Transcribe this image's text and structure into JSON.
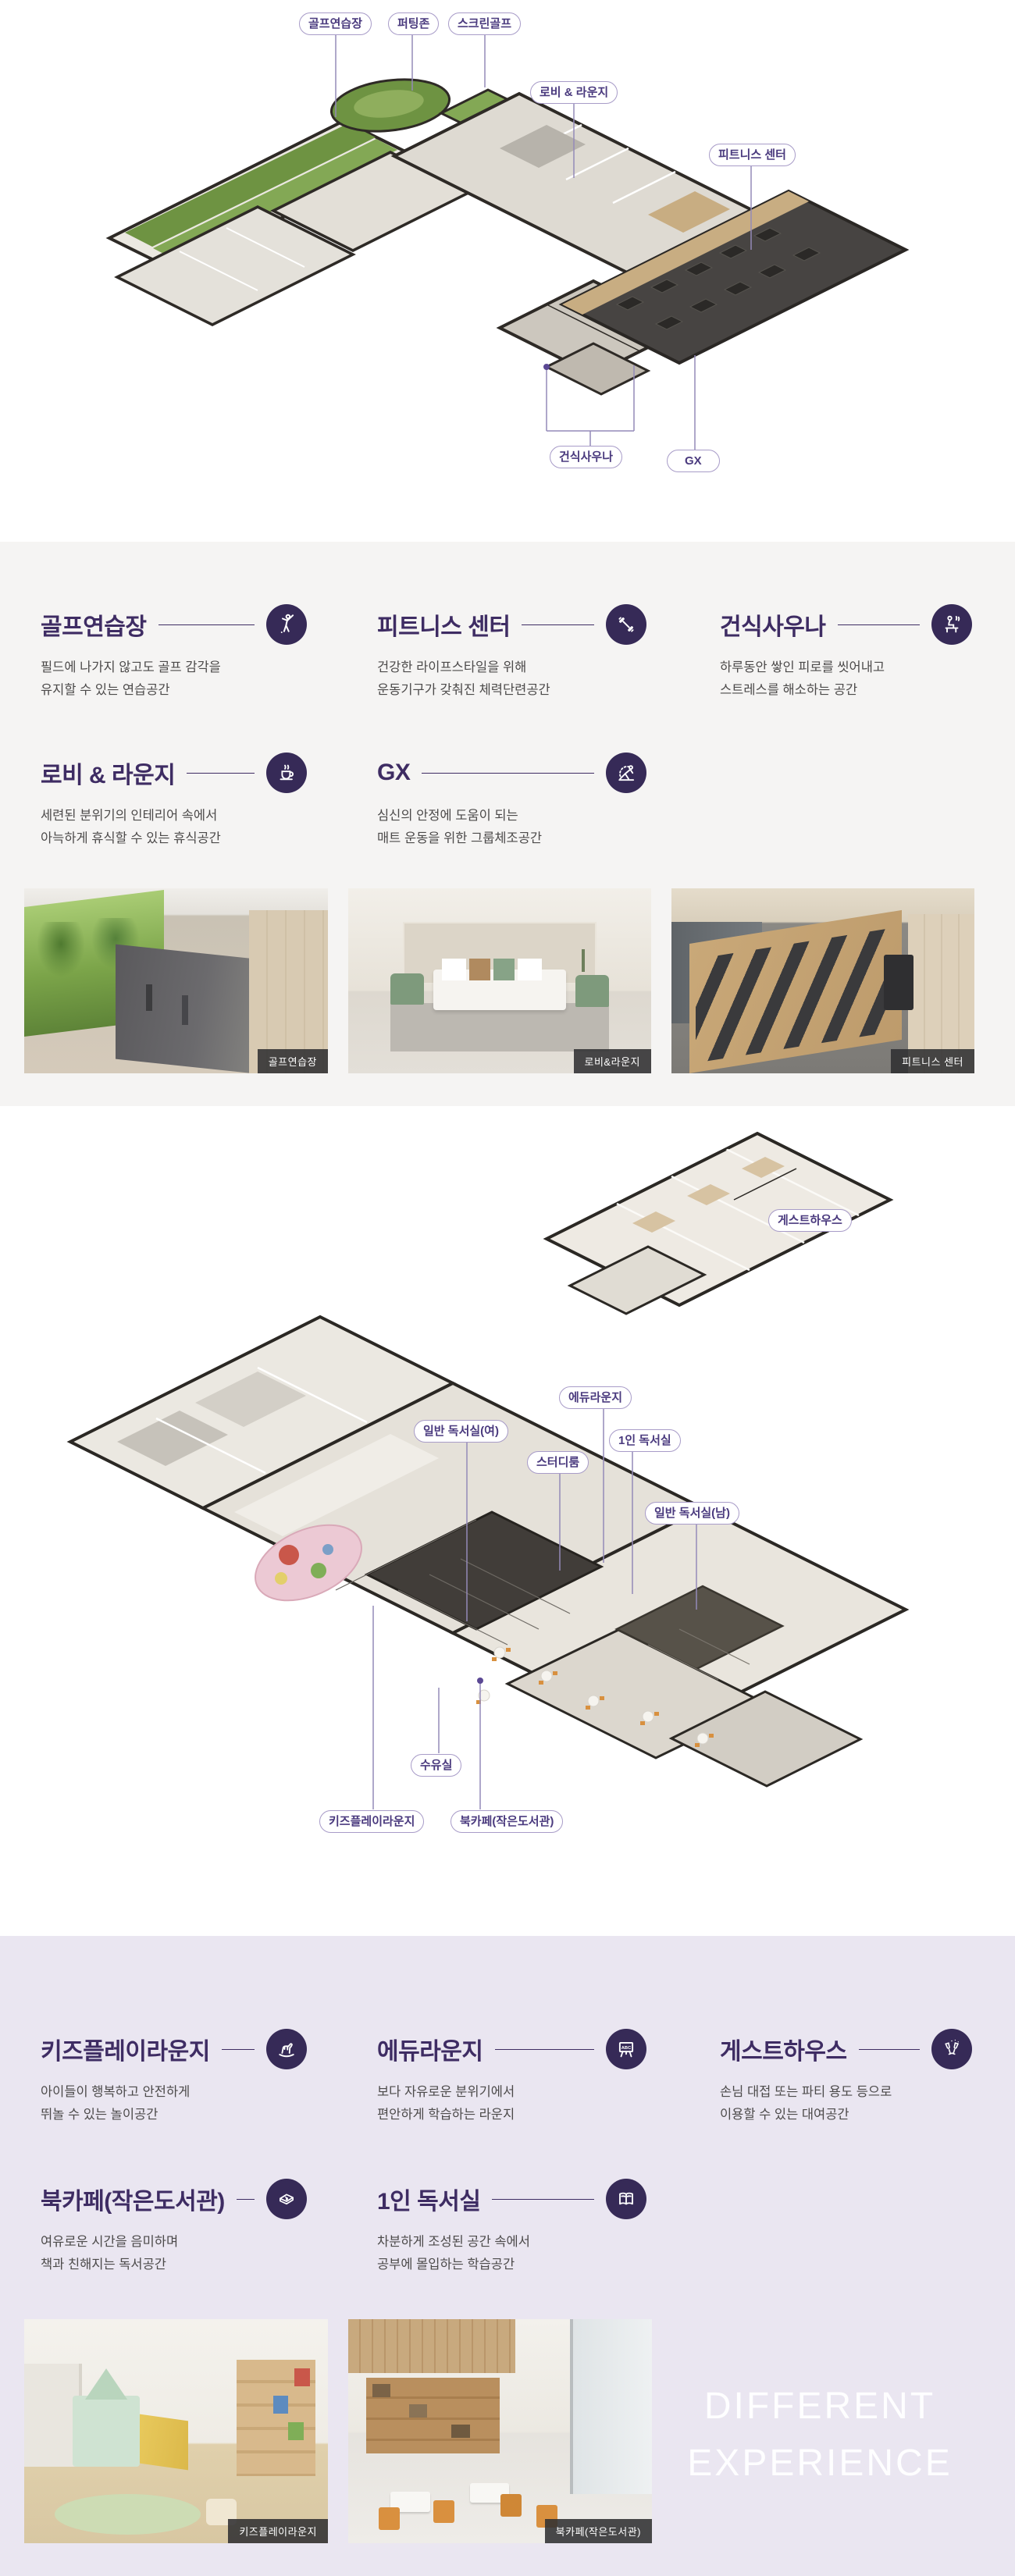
{
  "theme": {
    "accent": "#3e2c63",
    "icon_circle_bg": "#362a57",
    "label_border": "#a89cc8",
    "label_text": "#4a3a7e",
    "section1_bg": "#f5f4f3",
    "section2_bg": "#eae6f1",
    "caption_bg": "#303032",
    "connector_line": "#948ab8"
  },
  "plan1": {
    "labels": [
      {
        "text": "골프연습장"
      },
      {
        "text": "퍼팅존"
      },
      {
        "text": "스크린골프"
      },
      {
        "text": "로비 & 라운지"
      },
      {
        "text": "피트니스 센터"
      },
      {
        "text": "건식사우나"
      },
      {
        "text": "GX"
      }
    ]
  },
  "facilities1": {
    "features": [
      {
        "title": "골프연습장",
        "icon": "golfer-icon",
        "desc": "필드에 나가지 않고도 골프 감각을\n유지할 수 있는 연습공간"
      },
      {
        "title": "피트니스 센터",
        "icon": "dumbbell-icon",
        "desc": "건강한 라이프스타일을 위해\n운동기구가 갖춰진 체력단련공간"
      },
      {
        "title": "건식사우나",
        "icon": "sauna-icon",
        "desc": "하루동안 쌓인 피로를 씻어내고\n스트레스를 해소하는 공간"
      },
      {
        "title": "로비 & 라운지",
        "icon": "coffee-icon",
        "desc": "세련된 분위기의 인테리어 속에서\n아늑하게 휴식할 수 있는 휴식공간"
      },
      {
        "title": "GX",
        "icon": "yoga-icon",
        "desc": "심신의 안정에 도움이 되는\n매트 운동을 위한 그룹체조공간"
      }
    ],
    "photos": [
      {
        "caption": "골프연습장"
      },
      {
        "caption": "로비&라운지"
      },
      {
        "caption": "피트니스 센터"
      }
    ]
  },
  "plan2": {
    "labels": [
      {
        "text": "게스트하우스"
      },
      {
        "text": "에듀라운지"
      },
      {
        "text": "일반 독서실(여)"
      },
      {
        "text": "1인 독서실"
      },
      {
        "text": "스터디룸"
      },
      {
        "text": "일반 독서실(남)"
      },
      {
        "text": "수유실"
      },
      {
        "text": "키즈플레이라운지"
      },
      {
        "text": "북카페(작은도서관)"
      }
    ]
  },
  "facilities2": {
    "features": [
      {
        "title": "키즈플레이라운지",
        "icon": "rocking-horse-icon",
        "desc": "아이들이 행복하고 안전하게\n뛰놀 수 있는 놀이공간"
      },
      {
        "title": "에듀라운지",
        "icon": "chalkboard-icon",
        "desc": "보다 자유로운 분위기에서\n편안하게 학습하는 라운지"
      },
      {
        "title": "게스트하우스",
        "icon": "party-glasses-icon",
        "desc": "손님 대접 또는 파티 용도 등으로\n이용할 수 있는 대여공간"
      },
      {
        "title": "북카페(작은도서관)",
        "icon": "book-icon",
        "desc": "여유로운 시간을 음미하며\n책과 친해지는 독서공간"
      },
      {
        "title": "1인 독서실",
        "icon": "open-book-icon",
        "desc": "차분하게 조성된 공간 속에서\n공부에 몰입하는 학습공간"
      }
    ],
    "photos": [
      {
        "caption": "키즈플레이라운지"
      },
      {
        "caption": "북카페(작은도서관)"
      }
    ],
    "tagline": {
      "line1": "DIFFERENT",
      "line2": "EXPERIENCE"
    }
  }
}
